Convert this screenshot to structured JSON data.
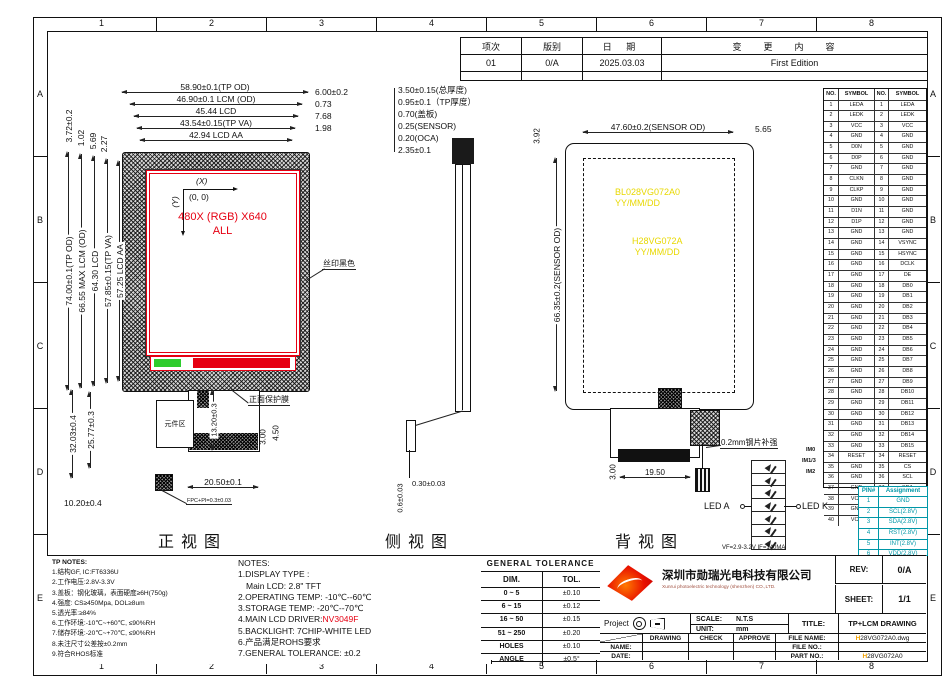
{
  "colors": {
    "accent_red": "#e60012",
    "marking_yellow": "#e8d800",
    "pin_table_cyan": "#0097a7",
    "logo_red": "#d40000"
  },
  "grid": {
    "cols": [
      "1",
      "2",
      "3",
      "4",
      "5",
      "6",
      "7",
      "8"
    ],
    "rows": [
      "A",
      "B",
      "C",
      "D",
      "E"
    ]
  },
  "revision": {
    "h_item": "项次",
    "h_ver": "版别",
    "h_date": "日 期",
    "h_content": "变更内容",
    "row_item": "01",
    "row_ver": "0/A",
    "row_date": "2025.03.03",
    "row_content": "First Edition"
  },
  "front_view": {
    "label": "正视图",
    "axis_x": "(X)",
    "axis_y": "(Y)",
    "origin": "(0, 0)",
    "screen_line1": "480X (RGB) X640",
    "screen_line2": "ALL",
    "top_dims": [
      "58.90±0.1(TP OD)",
      "46.90±0.1  LCM  (OD)",
      "45.44  LCD",
      "43.54±0.15(TP VA)",
      "42.94  LCD  AA"
    ],
    "top_right_dims": [
      "6.00±0.2",
      "0.73",
      "7.68",
      "1.98"
    ],
    "top_left_dims": [
      "3.72±0.2",
      "1.02",
      "5.69",
      "2.27"
    ],
    "left_dims": [
      "74.00±0.1(TP OD)",
      "66.55  MAX  LCM  (OD)",
      "64.30  LCD",
      "57.85±0.15(TP VA)",
      "57.25  LCD  AA"
    ],
    "dim_32": "32.03±0.4",
    "dim_25": "25.77±0.3",
    "dim_10": "10.20±0.4",
    "dim_13": "13.20±0.3",
    "dim_3": "3.00",
    "dim_4_5": "4.50",
    "dim_20_5": "20.50±0.1",
    "label_silk": "丝印黑色",
    "label_film": "正面保护膜",
    "label_component": "元件区",
    "label_fpc": "FPC+PI=0.3±0.03"
  },
  "side_view": {
    "label": "侧视图",
    "dims": [
      "3.50±0.15(总厚度)",
      "0.95±0.1（TP厚度）",
      "0.70(盖板)",
      "0.25(SENSOR)",
      "0.20(OCA)",
      "2.35±0.1"
    ],
    "dim_h": "0.30±0.03",
    "dim_v": "0.6±0.03"
  },
  "back_view": {
    "label": "背视图",
    "top_dim": "47.60±0.2(SENSOR OD)",
    "dim_5_65": "5.65",
    "dim_3_92": "3.92",
    "left_dim": "66.35±0.2(SENSOR OD)",
    "mark1_l1": "BL028VG072A0",
    "mark1_l2": "YY/MM/DD",
    "mark2_l1": "H28VG072A",
    "mark2_l2": "YY/MM/DD",
    "steel_note": "0.2mm钢片补强",
    "dim_3": "3.00",
    "dim_19_5": "19.50"
  },
  "led": {
    "anode": "LED A",
    "cathode": "LED K",
    "spec": "VF=2.9-3.2V   IF=140MA",
    "im": [
      "IM0",
      "IM1/3",
      "IM2"
    ]
  },
  "pin_table": {
    "headers": [
      "NO.",
      "SYMBOL",
      "NO.",
      "SYMBOL"
    ],
    "rows": [
      [
        "1",
        "LEDA",
        "1",
        "LEDA"
      ],
      [
        "2",
        "LEDK",
        "2",
        "LEDK"
      ],
      [
        "3",
        "VCC",
        "3",
        "VCC"
      ],
      [
        "4",
        "GND",
        "4",
        "GND"
      ],
      [
        "5",
        "D0N",
        "5",
        "GND"
      ],
      [
        "6",
        "D0P",
        "6",
        "GND"
      ],
      [
        "7",
        "GND",
        "7",
        "GND"
      ],
      [
        "8",
        "CLKN",
        "8",
        "GND"
      ],
      [
        "9",
        "CLKP",
        "9",
        "GND"
      ],
      [
        "10",
        "GND",
        "10",
        "GND"
      ],
      [
        "11",
        "D1N",
        "11",
        "GND"
      ],
      [
        "12",
        "D1P",
        "12",
        "GND"
      ],
      [
        "13",
        "GND",
        "13",
        "GND"
      ],
      [
        "14",
        "GND",
        "14",
        "VSYNC"
      ],
      [
        "15",
        "GND",
        "15",
        "HSYNC"
      ],
      [
        "16",
        "GND",
        "16",
        "DCLK"
      ],
      [
        "17",
        "GND",
        "17",
        "DE"
      ],
      [
        "18",
        "GND",
        "18",
        "DB0"
      ],
      [
        "19",
        "GND",
        "19",
        "DB1"
      ],
      [
        "20",
        "GND",
        "20",
        "DB2"
      ],
      [
        "21",
        "GND",
        "21",
        "DB3"
      ],
      [
        "22",
        "GND",
        "22",
        "DB4"
      ],
      [
        "23",
        "GND",
        "23",
        "DB5"
      ],
      [
        "24",
        "GND",
        "24",
        "DB6"
      ],
      [
        "25",
        "GND",
        "25",
        "DB7"
      ],
      [
        "26",
        "GND",
        "26",
        "DB8"
      ],
      [
        "27",
        "GND",
        "27",
        "DB9"
      ],
      [
        "28",
        "GND",
        "28",
        "DB10"
      ],
      [
        "29",
        "GND",
        "29",
        "DB11"
      ],
      [
        "30",
        "GND",
        "30",
        "DB12"
      ],
      [
        "31",
        "GND",
        "31",
        "DB13"
      ],
      [
        "32",
        "GND",
        "32",
        "DB14"
      ],
      [
        "33",
        "GND",
        "33",
        "DB15"
      ],
      [
        "34",
        "RESET",
        "34",
        "RESET"
      ],
      [
        "35",
        "GND",
        "35",
        "CS"
      ],
      [
        "36",
        "GND",
        "36",
        "SCL"
      ],
      [
        "37",
        "GND",
        "37",
        "SDA"
      ],
      [
        "38",
        "VCC",
        "38",
        "GND"
      ],
      [
        "39",
        "GND",
        "39",
        "VCC"
      ],
      [
        "40",
        "VCC",
        "40",
        "GND"
      ]
    ]
  },
  "pin_assignment": {
    "headers": [
      "PIN#",
      "Assignment"
    ],
    "rows": [
      [
        "1",
        "GND"
      ],
      [
        "2",
        "SCL(2.8V)"
      ],
      [
        "3",
        "SDA(2.8V)"
      ],
      [
        "4",
        "RST(2.8V)"
      ],
      [
        "5",
        "INT(2.8V)"
      ],
      [
        "6",
        "VDD(2.8V)"
      ]
    ]
  },
  "tp_notes": {
    "title": "TP NOTES:",
    "lines": [
      "1.结构GF, IC:FT6336U",
      "2.工作电压:2.8V-3.3V",
      "3.盖板：钢化玻璃，表面硬度≥6H(750g)",
      "4.强度: CS≥450Mpa, DOL≥8um",
      "5.透光率:≥84%",
      "6.工作环境:-10℃~+60℃, ≤90%RH",
      "7.储存环境:-20℃~+70℃, ≤90%RH",
      "8.未注尺寸公差按±0.2mm",
      "9.符合RHOS标准"
    ]
  },
  "notes": {
    "title": "NOTES:",
    "l1": "1.DISPLAY  TYPE :",
    "l1b": "Main  LCD: 2.8\" TFT",
    "l2": "2.OPERATING  TEMP:  -10℃--60℃",
    "l3": "3.STORAGE  TEMP:   -20℃--70℃",
    "l4a": "4.MAIN  LCD  DRIVER:",
    "l4b": "NV3049F",
    "l5": "5.BACKLIGHT:  7CHIP-WHITE  LED",
    "l6": "6.产品满足ROHS要求",
    "l7": "7.GENERAL  TOLERANCE: ±0.2"
  },
  "tolerance": {
    "title": "GENERAL  TOLERANCE",
    "col_dim": "DIM.",
    "col_tol": "TOL.",
    "rows": [
      [
        "0  ~  5",
        "±0.10"
      ],
      [
        "6  ~  15",
        "±0.12"
      ],
      [
        "16  ~  50",
        "±0.15"
      ],
      [
        "51  ~  250",
        "±0.20"
      ],
      [
        "HOLES",
        "±0.10"
      ],
      [
        "ANGLE",
        "±0.5°"
      ]
    ]
  },
  "title_block": {
    "company_cn": "深圳市勋瑞光电科技有限公司",
    "company_en": "Xunrui  photoelectric technology  (shenzhen)  CO.,LTD.",
    "rev_label": "REV:",
    "rev": "0/A",
    "sheet_label": "SHEET:",
    "sheet": "1/1",
    "project_label": "Project",
    "scale_label": "SCALE:",
    "scale": "N.T.S",
    "unit_label": "UNIT:",
    "unit": "mm",
    "title_label": "TITLE:",
    "title": "TP+LCM  DRAWING",
    "drawing": "DRAWING",
    "check": "CHECK",
    "approve": "APPROVE",
    "name_label": "NAME:",
    "date_label": "DATE:",
    "file_name_label": "FILE  NAME:",
    "file_name_h": "H",
    "file_name_rest": "28VG072A0.dwg",
    "file_no_label": "FILE  NO.:",
    "part_no_label": "PART  NO.:",
    "part_no_h": "H",
    "part_no_rest": "28VG072A0"
  }
}
